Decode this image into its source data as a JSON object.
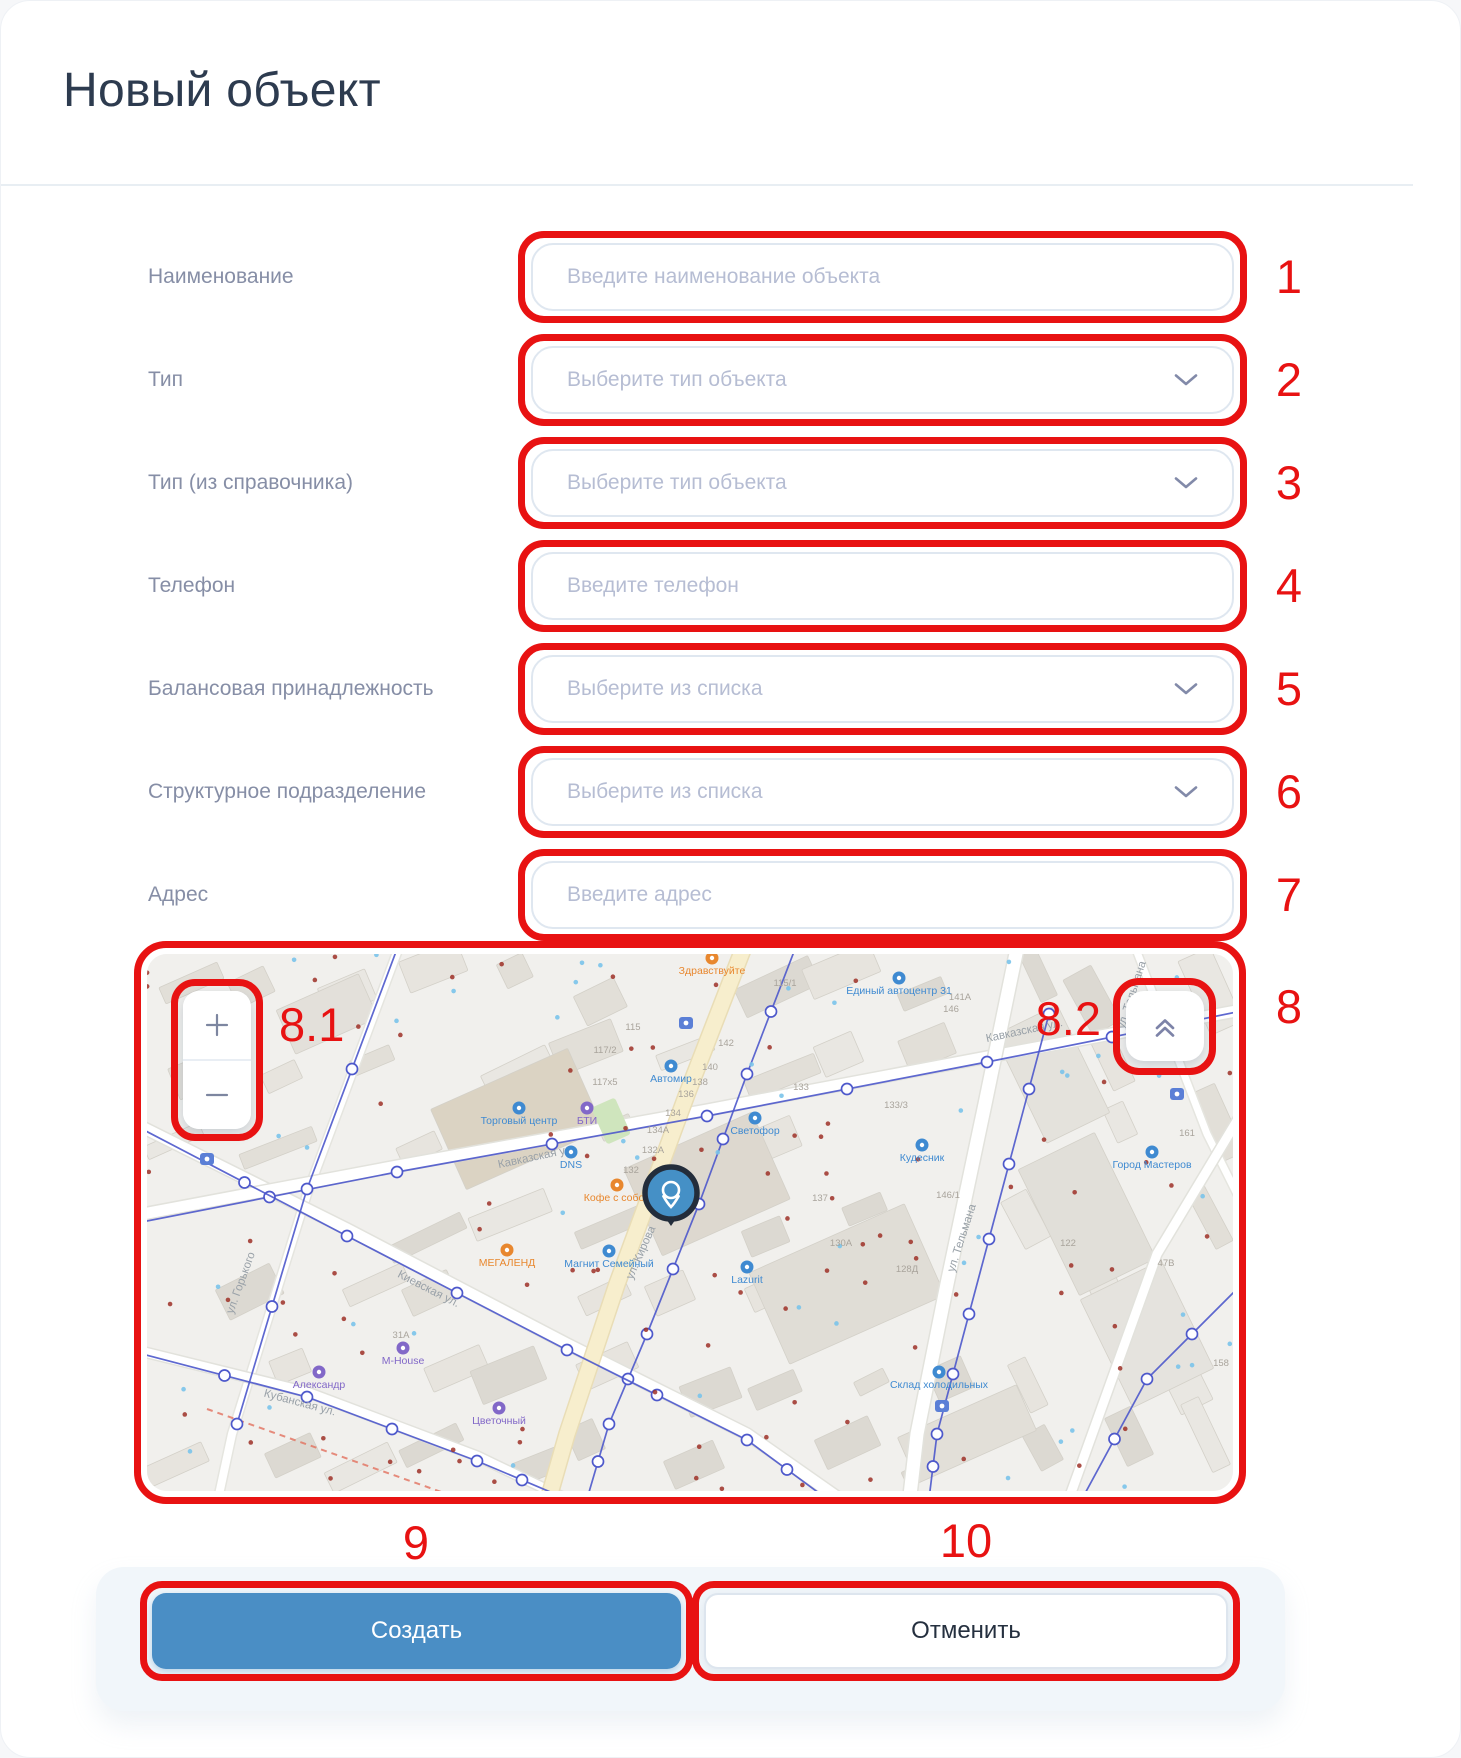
{
  "title": "Новый объект",
  "form": {
    "rows": [
      {
        "name": "name",
        "label": "Наименование",
        "placeholder": "Введите наименование объекта",
        "control": "input",
        "number": "1"
      },
      {
        "name": "type",
        "label": "Тип",
        "placeholder": "Выберите тип объекта",
        "control": "select",
        "number": "2"
      },
      {
        "name": "type-ref",
        "label": "Тип (из справочника)",
        "placeholder": "Выберите тип объекта",
        "control": "select",
        "number": "3"
      },
      {
        "name": "phone",
        "label": "Телефон",
        "placeholder": "Введите телефон",
        "control": "input",
        "number": "4"
      },
      {
        "name": "balance",
        "label": "Балансовая принадлежность",
        "placeholder": "Выберите из списка",
        "control": "select",
        "number": "5"
      },
      {
        "name": "division",
        "label": "Структурное подразделение",
        "placeholder": "Выберите из списка",
        "control": "select",
        "number": "6"
      },
      {
        "name": "address",
        "label": "Адрес",
        "placeholder": "Введите адрес",
        "control": "input",
        "number": "7"
      }
    ]
  },
  "buttons": {
    "create_label": "Создать",
    "cancel_label": "Отменить"
  },
  "annotations": {
    "map": "8",
    "map_zoom": "8.1",
    "map_collapse": "8.2",
    "create": "9",
    "cancel": "10"
  },
  "map": {
    "zoom_in_glyph": "+",
    "zoom_out_glyph": "−",
    "collapse_icon": "double-chevron-up-icon",
    "pin": {
      "x": 524,
      "y": 239
    },
    "labels": [
      {
        "text": "ул. Кирова",
        "x": 497,
        "y": 300,
        "rot": -66,
        "kind": "street"
      },
      {
        "text": "ул. Тельмана",
        "x": 818,
        "y": 285,
        "rot": -72,
        "kind": "street"
      },
      {
        "text": "ул. Тельмана",
        "x": 988,
        "y": 42,
        "rot": -72,
        "kind": "street"
      },
      {
        "text": "Кавказская ул.",
        "x": 878,
        "y": 80,
        "rot": -12,
        "kind": "street"
      },
      {
        "text": "Кавказская ул.",
        "x": 390,
        "y": 206,
        "rot": -12,
        "kind": "street"
      },
      {
        "text": "Киевская ул.",
        "x": 280,
        "y": 338,
        "rot": 27,
        "kind": "street"
      },
      {
        "text": "Кубанская ул.",
        "x": 152,
        "y": 452,
        "rot": 15,
        "kind": "street"
      },
      {
        "text": "ул. Горького",
        "x": 97,
        "y": 330,
        "rot": -70,
        "kind": "street"
      },
      {
        "text": "Автомир",
        "x": 524,
        "y": 128,
        "rot": 0,
        "kind": "poi_blue"
      },
      {
        "text": "Светофор",
        "x": 608,
        "y": 180,
        "rot": 0,
        "kind": "poi_blue"
      },
      {
        "text": "Единый автоцентр 31",
        "x": 752,
        "y": 40,
        "rot": 0,
        "kind": "poi_blue"
      },
      {
        "text": "Кудесник",
        "x": 775,
        "y": 207,
        "rot": 0,
        "kind": "poi_blue"
      },
      {
        "text": "DNS",
        "x": 424,
        "y": 214,
        "rot": 0,
        "kind": "poi_blue"
      },
      {
        "text": "Lazurit",
        "x": 600,
        "y": 329,
        "rot": 0,
        "kind": "poi_blue"
      },
      {
        "text": "Магнит Семейный",
        "x": 462,
        "y": 313,
        "rot": 0,
        "kind": "poi_blue"
      },
      {
        "text": "Город Мастеров",
        "x": 1005,
        "y": 214,
        "rot": 0,
        "kind": "poi_blue"
      },
      {
        "text": "Склад холодильных",
        "x": 792,
        "y": 434,
        "rot": 0,
        "kind": "poi_blue"
      },
      {
        "text": "Торговый центр",
        "x": 372,
        "y": 170,
        "rot": 0,
        "kind": "poi_blue"
      },
      {
        "text": "Здравствуйте",
        "x": 565,
        "y": 20,
        "rot": 0,
        "kind": "poi_orange"
      },
      {
        "text": "Кофе с собой",
        "x": 470,
        "y": 247,
        "rot": 0,
        "kind": "poi_orange"
      },
      {
        "text": "МЕГАЛЕНД",
        "x": 360,
        "y": 312,
        "rot": 0,
        "kind": "poi_orange"
      },
      {
        "text": "БТИ",
        "x": 440,
        "y": 170,
        "rot": 0,
        "kind": "poi_purple"
      },
      {
        "text": "M-House",
        "x": 256,
        "y": 410,
        "rot": 0,
        "kind": "poi_purple"
      },
      {
        "text": "Александр",
        "x": 172,
        "y": 434,
        "rot": 0,
        "kind": "poi_purple"
      },
      {
        "text": "Цветочный",
        "x": 352,
        "y": 470,
        "rot": 0,
        "kind": "poi_purple"
      },
      {
        "text": "115",
        "x": 486,
        "y": 76,
        "rot": 0,
        "kind": "housenum"
      },
      {
        "text": "115/1",
        "x": 638,
        "y": 32,
        "rot": 0,
        "kind": "housenum"
      },
      {
        "text": "117/2",
        "x": 458,
        "y": 99,
        "rot": 0,
        "kind": "housenum"
      },
      {
        "text": "117х5",
        "x": 458,
        "y": 131,
        "rot": 0,
        "kind": "housenum"
      },
      {
        "text": "142",
        "x": 579,
        "y": 92,
        "rot": 0,
        "kind": "housenum"
      },
      {
        "text": "140",
        "x": 563,
        "y": 116,
        "rot": 0,
        "kind": "housenum"
      },
      {
        "text": "138",
        "x": 553,
        "y": 131,
        "rot": 0,
        "kind": "housenum"
      },
      {
        "text": "136",
        "x": 539,
        "y": 143,
        "rot": 0,
        "kind": "housenum"
      },
      {
        "text": "134",
        "x": 526,
        "y": 162,
        "rot": 0,
        "kind": "housenum"
      },
      {
        "text": "134А",
        "x": 511,
        "y": 179,
        "rot": 0,
        "kind": "housenum"
      },
      {
        "text": "132А",
        "x": 506,
        "y": 199,
        "rot": 0,
        "kind": "housenum"
      },
      {
        "text": "132",
        "x": 484,
        "y": 219,
        "rot": 0,
        "kind": "housenum"
      },
      {
        "text": "133",
        "x": 654,
        "y": 136,
        "rot": 0,
        "kind": "housenum"
      },
      {
        "text": "141А",
        "x": 813,
        "y": 46,
        "rot": 0,
        "kind": "housenum"
      },
      {
        "text": "146",
        "x": 804,
        "y": 58,
        "rot": 0,
        "kind": "housenum"
      },
      {
        "text": "133/3",
        "x": 749,
        "y": 154,
        "rot": 0,
        "kind": "housenum"
      },
      {
        "text": "137",
        "x": 673,
        "y": 247,
        "rot": 0,
        "kind": "housenum"
      },
      {
        "text": "146/1",
        "x": 801,
        "y": 244,
        "rot": 0,
        "kind": "housenum"
      },
      {
        "text": "128Д",
        "x": 760,
        "y": 318,
        "rot": 0,
        "kind": "housenum"
      },
      {
        "text": "130А",
        "x": 694,
        "y": 292,
        "rot": 0,
        "kind": "housenum"
      },
      {
        "text": "47В",
        "x": 1019,
        "y": 312,
        "rot": 0,
        "kind": "housenum"
      },
      {
        "text": "122",
        "x": 921,
        "y": 292,
        "rot": 0,
        "kind": "housenum"
      },
      {
        "text": "158",
        "x": 1074,
        "y": 412,
        "rot": 0,
        "kind": "housenum"
      },
      {
        "text": "161",
        "x": 1040,
        "y": 182,
        "rot": 0,
        "kind": "housenum"
      },
      {
        "text": "31А",
        "x": 254,
        "y": 384,
        "rot": 0,
        "kind": "housenum"
      }
    ]
  },
  "colors": {
    "annotation_red": "#e81212",
    "primary_blue": "#4a8ec5",
    "title_color": "#2d3b4f",
    "label_color": "#868ea6",
    "placeholder_color": "#b6bdd3",
    "pin_fill": "#4590c6",
    "pin_ring": "#232d3b",
    "footer_bg": "#f1f6fa"
  }
}
